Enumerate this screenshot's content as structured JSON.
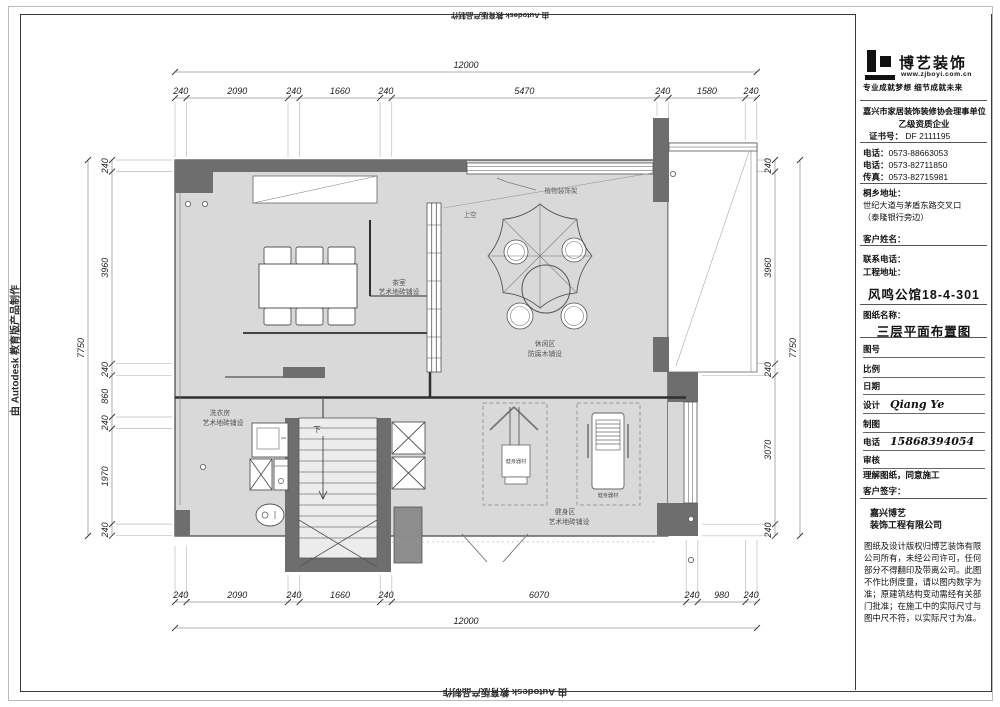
{
  "watermark": {
    "text": "由 Autodesk 教育版产品制作"
  },
  "dimensions": {
    "top_total": "12000",
    "top_chain": [
      "240",
      "2090",
      "240",
      "1660",
      "240",
      "5470",
      "240",
      "1580",
      "240"
    ],
    "bottom_chain": [
      "240",
      "2090",
      "240",
      "1660",
      "240",
      "6070",
      "240",
      "980",
      "240"
    ],
    "bottom_total": "12000",
    "left_total": "7750",
    "left_chain": [
      "240",
      "3960",
      "240",
      "860",
      "240",
      "1970",
      "240"
    ],
    "right_chain": [
      "240",
      "3960",
      "240",
      "3070",
      "240"
    ],
    "right_total": "7750"
  },
  "plan": {
    "rooms": {
      "tea": {
        "name": "茶室",
        "finish": "艺术地砖铺设"
      },
      "leisure": {
        "name": "休闲区",
        "finish": "防腐木铺设"
      },
      "laundry": {
        "name": "洗衣房",
        "finish": "艺术地砖铺设"
      },
      "gym": {
        "name": "健身区",
        "finish": "艺术地砖铺设"
      }
    },
    "annotations": {
      "equipment": "健身器材",
      "plant_shelf": "植物装饰架",
      "void_above": "上空",
      "stairs_down": "下"
    }
  },
  "title_block": {
    "brand": {
      "name": "博艺装饰",
      "website": "www.zjboyi.com.cn",
      "tagline": "专业成就梦想 细节成就未来"
    },
    "credentials": {
      "association": "嘉兴市家居装饰装修协会理事单位",
      "grade": "乙级资质企业",
      "cert_label": "证书号：",
      "cert_no": "DF 2111195"
    },
    "contacts": {
      "tel1_label": "电话：",
      "tel1": "0573-88663053",
      "tel2_label": "电话：",
      "tel2": "0573-82711850",
      "fax_label": "传真：",
      "fax": "0573-82715981"
    },
    "address": {
      "label": "桐乡地址：",
      "line1": "世纪大道与茅盾东路交叉口",
      "line2": "（泰隆银行旁边）"
    },
    "fields": {
      "customer_label": "客户姓名：",
      "contact_label": "联系电话：",
      "site_label": "工程地址：",
      "project_name": "风鸣公馆18-4-301",
      "drawing_label": "图纸名称：",
      "drawing_name": "三层平面布置图",
      "fig_label": "图号",
      "scale_label": "比例",
      "date_label": "日期",
      "design_label": "设计",
      "designer": "Qiang Ye",
      "draft_label": "制图",
      "tel_label": "电话",
      "tel_value": "15868394054",
      "review_label": "审核",
      "agreement": "理解图纸，同意施工",
      "sign_label": "客户签字：",
      "company_line1": "嘉兴博艺",
      "company_line2": "装饰工程有限公司",
      "disclaimer": "图纸及设计版权归博艺装饰有限公司所有，未经公司许可，任何部分不得翻印及带离公司。此图不作比例度量，请以图内数字为准；原建筑结构变动需经有关部门批准；在施工中的实际尺寸与图中尺不符，以实际尺寸为准。"
    }
  },
  "colors": {
    "floor": "#d9d9d9",
    "wall": "#6e6e6e",
    "accent": "#111111"
  }
}
